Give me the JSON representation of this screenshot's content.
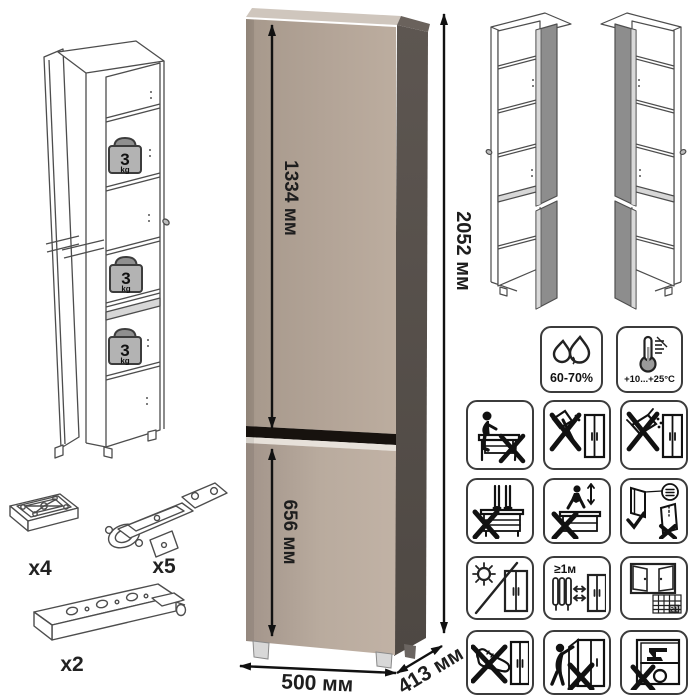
{
  "dimensions": {
    "total_height": "2052 мм",
    "upper_door": "1334 мм",
    "lower_door": "656 мм",
    "width": "500 мм",
    "depth": "413 мм"
  },
  "shelf_load": {
    "value": "3",
    "unit": "kg"
  },
  "hardware": {
    "foot_qty": "x4",
    "hinge_qty": "x5",
    "rail_qty": "x2"
  },
  "conditions": {
    "humidity": "60-70%",
    "temperature": "+10...+25°C"
  },
  "placement": {
    "min_heat_distance": "≥1м",
    "calendar_day": "21"
  },
  "colors": {
    "front_door": "#b1a296",
    "lower_door": "#b7a89b",
    "side_panel": "#5a534e",
    "top_edge": "#cfc6bd",
    "door_gap": "#17120e",
    "open_door_gray": "#8d8d8d",
    "weight_badge": "#b3b3b3"
  },
  "care_icons": [
    "humidity",
    "temperature-range",
    "no-sitting",
    "no-sharp-tools",
    "no-spilling",
    "no-standing",
    "no-jumping",
    "door-adjustment",
    "avoid-sunlight",
    "heat-distance",
    "room-ventilation",
    "no-foot-pushing",
    "no-door-hanging",
    "no-overloading"
  ]
}
